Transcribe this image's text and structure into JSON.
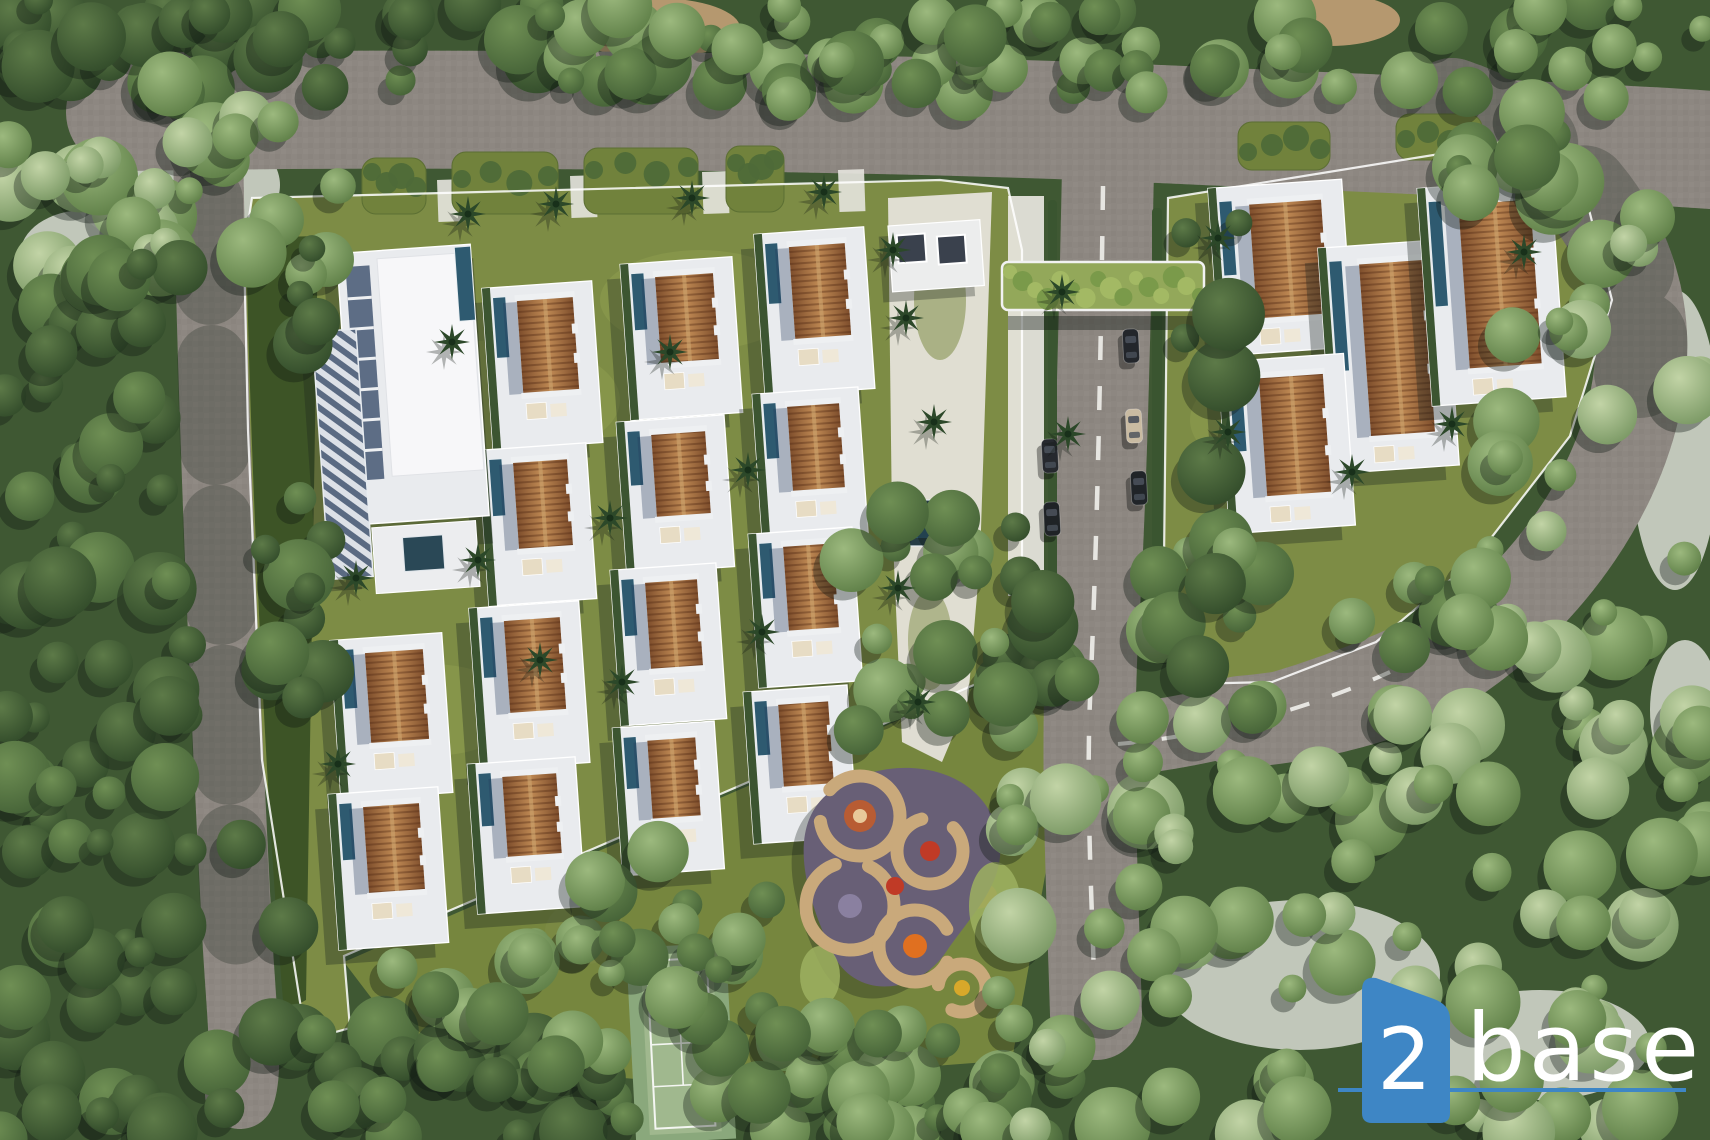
{
  "watermark": {
    "number": "2",
    "name": "base",
    "badge_color": "#3e86c5",
    "underline_color": "#3e86c5",
    "text_color": "#ffffff"
  },
  "scene": {
    "description": "Aerial 3D master-plan render of a tropical villa resort: two clusters of brown-roofed pool villas amid forest, central access road with cars, entrance pergola, clubhouse, kids playground, tennis court and perimeter roads",
    "counts": {
      "villas": 18,
      "clubhouse": 1,
      "cars": 5,
      "playground": 1,
      "tennis_court": 1
    },
    "features": [
      "forest",
      "perimeter-road",
      "central-road",
      "entrance-pergola",
      "villa-clusters",
      "private-pools",
      "clubhouse",
      "spine-garden",
      "water-feature",
      "kids-playground",
      "tennis-court",
      "parking-bays"
    ],
    "palette": {
      "forest_dark": "#2f4a28",
      "forest_mid": "#48663a",
      "forest_light": "#6f915c",
      "forest_pale": "#93af7c",
      "lawn": "#7d8c45",
      "hedge": "#3a5530",
      "road": "#8d8781",
      "plot_white": "#e9ebee",
      "roof_brown": "#a06438",
      "pool_blue": "#2e5a70",
      "shadow_blue": "rgba(35,55,90,0.32)",
      "playground_sand": "#c9a97b",
      "playground_base": "#685f76",
      "tennis_green": "#a0b88e"
    }
  },
  "scene_data": {
    "bg": "#3f5833",
    "pale_blobs": [
      [
        70,
        120,
        210,
        130
      ],
      [
        20,
        210,
        130,
        90
      ],
      [
        1160,
        900,
        280,
        150
      ],
      [
        1430,
        990,
        220,
        110
      ],
      [
        1630,
        290,
        90,
        300
      ],
      [
        545,
        900,
        80,
        64
      ],
      [
        1650,
        640,
        70,
        140
      ]
    ],
    "tan_blobs": [
      [
        655,
        28,
        85,
        30
      ],
      [
        1330,
        20,
        70,
        26
      ]
    ],
    "lawns": {
      "left": "M252,198 L940,180 L1008,188 L1022,250 L1022,648 L1004,672 L344,956 L350,1028 L306,1040 L262,760 L248,430 L244,250 Z",
      "below": "M344,962 L1000,676 L1062,700 L1064,770 L1012,1060 L700,1084 L420,1062 Z",
      "right": "M1168,198 L1452,152 L1585,194 L1612,300 L1570,436 L1474,560 L1376,642 L1272,682 L1186,684 L1164,560 Z",
      "right_ne": "M1490,120 L1648,152 L1658,250 L1600,298 L1556,200 Z",
      "patches": [
        [
          500,
          400,
          120,
          60
        ],
        [
          700,
          300,
          100,
          50
        ],
        [
          430,
          710,
          90,
          46
        ],
        [
          1300,
          420,
          110,
          60
        ],
        [
          880,
          880,
          70,
          40
        ]
      ]
    },
    "roads": {
      "color": "#8d8781",
      "paths": [
        [
          "M125,112 C480,106 900,112 1205,126 C1430,136 1600,142 1712,150",
          118
        ],
        [
          "M208,140 C212,420 228,760 238,950 C243,1030 248,1072 240,1094",
          70
        ],
        [
          "M1108,168 C1104,360 1100,520 1092,640 C1086,760 1092,880 1096,1014",
          92
        ],
        [
          "M1098,742 C1180,736 1290,712 1398,664",
          72
        ],
        [
          "M1452,104 C1582,148 1652,258 1640,372 C1628,486 1546,598 1448,662 C1396,696 1312,716 1240,722",
          92
        ]
      ],
      "shade": [
        [
          "M208,200 C214,480 228,780 238,960",
          70
        ],
        [
          "M1452,104 C1582,148 1652,258 1640,372",
          92
        ]
      ],
      "dashes": [
        [
          "M1103,186 C1100,420 1096,560 1090,700 C1086,800 1092,900 1095,1008",
          4.5,
          "24 26"
        ],
        [
          "M1118,744 C1200,737 1300,713 1390,672",
          4,
          "20 24"
        ]
      ]
    },
    "hedge_wedge": "M246,238 L318,236 L306,1000 L284,1012 C264,780 250,440 246,238 Z",
    "sidewalk": [
      1008,
      196,
      36,
      400
    ],
    "hedge_strips": [
      [
        1048,
        200,
        9,
        380
      ],
      [
        1152,
        208,
        10,
        340
      ]
    ],
    "parking_hedges": [
      [
        362,
        158,
        64,
        56
      ],
      [
        452,
        152,
        106,
        62
      ],
      [
        584,
        148,
        114,
        66
      ],
      [
        726,
        146,
        58,
        66
      ],
      [
        1238,
        122,
        92,
        48
      ],
      [
        1396,
        114,
        86,
        46
      ]
    ],
    "stubs": [
      [
        437,
        180,
        26,
        42
      ],
      [
        570,
        176,
        26,
        42
      ],
      [
        702,
        172,
        26,
        42
      ],
      [
        838,
        170,
        26,
        42
      ]
    ],
    "spine": {
      "path": "M888,198 L992,192 L980,560 L968,700 L942,762 L902,742 L892,520 Z",
      "water": [
        898,
        500,
        42,
        46
      ]
    },
    "amenity": {
      "x": 888,
      "y": 226,
      "w": 92,
      "h": 66,
      "cabins": [
        [
          8,
          10,
          28,
          28
        ],
        [
          48,
          14,
          28,
          28
        ]
      ]
    },
    "pergola": {
      "x": 1002,
      "y": 262,
      "w": 202,
      "h": 48
    },
    "villas": {
      "angle": -4,
      "left": [
        [
          368,
          648,
          58,
          96
        ],
        [
          366,
          802,
          56,
          92
        ],
        [
          520,
          296,
          56,
          98
        ],
        [
          516,
          458,
          54,
          92
        ],
        [
          507,
          616,
          56,
          98
        ],
        [
          505,
          772,
          54,
          86
        ],
        [
          658,
          272,
          58,
          92
        ],
        [
          654,
          430,
          54,
          88
        ],
        [
          648,
          578,
          52,
          92
        ],
        [
          650,
          736,
          48,
          84
        ],
        [
          792,
          242,
          56,
          98
        ],
        [
          790,
          402,
          52,
          90
        ],
        [
          786,
          542,
          50,
          90
        ],
        [
          781,
          700,
          50,
          88
        ]
      ],
      "right": [
        [
          1253,
          199,
          72,
          120
        ],
        [
          1365,
          259,
          64,
          178
        ],
        [
          1464,
          199,
          72,
          170
        ],
        [
          1263,
          373,
          64,
          124
        ]
      ]
    },
    "clubhouse": {
      "x": 360,
      "y": 274
    },
    "trellis": {
      "x": 312,
      "y": 332,
      "w": 44,
      "h": 248
    },
    "cars": [
      [
        1050,
        456,
        -3,
        "#26292e"
      ],
      [
        1052,
        519,
        -3,
        "#1f2326"
      ],
      [
        1131,
        346,
        -3,
        "#23262b"
      ],
      [
        1134,
        426,
        -3,
        "#c9bba2"
      ],
      [
        1139,
        488,
        -3,
        "#202428"
      ]
    ],
    "playground": {
      "x": 790,
      "y": 756,
      "base": "M40,36 C96,-4 180,6 204,64 C226,118 186,152 156,196 C126,240 64,244 42,196 C20,150 -8,72 40,36 Z",
      "rings": [
        [
          70,
          60,
          40
        ],
        [
          140,
          95,
          33
        ],
        [
          60,
          150,
          44
        ],
        [
          125,
          190,
          36
        ],
        [
          172,
          232,
          24
        ]
      ],
      "dots": [
        [
          70,
          60,
          16,
          "#b85c33"
        ],
        [
          70,
          60,
          7,
          "#e8c99a"
        ],
        [
          140,
          95,
          10,
          "#c03a26"
        ],
        [
          125,
          190,
          12,
          "#e07020"
        ],
        [
          60,
          150,
          12,
          "#8a80a0"
        ],
        [
          172,
          232,
          8,
          "#d8a82a"
        ],
        [
          105,
          130,
          9,
          "#c03a26"
        ]
      ],
      "greens": [
        [
          205,
          150,
          26,
          44
        ],
        [
          30,
          220,
          20,
          30
        ]
      ]
    },
    "tennis": {
      "x": 626,
      "y": 948,
      "angle": -3
    },
    "forest": [
      [
        0,
        0,
        560,
        95,
        36,
        0
      ],
      [
        540,
        0,
        260,
        85,
        18,
        1
      ],
      [
        780,
        0,
        930,
        100,
        54,
        1
      ],
      [
        0,
        70,
        340,
        210,
        30,
        2
      ],
      [
        0,
        260,
        190,
        420,
        30,
        0
      ],
      [
        0,
        660,
        200,
        390,
        30,
        0
      ],
      [
        0,
        1030,
        640,
        110,
        34,
        0
      ],
      [
        600,
        1040,
        480,
        100,
        22,
        1
      ],
      [
        330,
        930,
        280,
        140,
        14,
        1
      ],
      [
        560,
        840,
        220,
        140,
        10,
        1
      ],
      [
        700,
        990,
        330,
        150,
        18,
        1
      ],
      [
        1010,
        700,
        700,
        440,
        88,
        2
      ],
      [
        1500,
        150,
        210,
        570,
        28,
        2
      ],
      [
        990,
        520,
        90,
        230,
        12,
        0
      ],
      [
        1140,
        530,
        130,
        190,
        12,
        1
      ],
      [
        840,
        490,
        160,
        250,
        16,
        1
      ],
      [
        1180,
        200,
        70,
        470,
        8,
        0
      ],
      [
        1320,
        430,
        180,
        220,
        12,
        1
      ],
      [
        1420,
        110,
        140,
        110,
        8,
        1
      ],
      [
        240,
        230,
        90,
        700,
        16,
        0
      ],
      [
        610,
        920,
        130,
        80,
        7,
        1
      ]
    ],
    "palms": [
      [
        468,
        214
      ],
      [
        556,
        204
      ],
      [
        692,
        198
      ],
      [
        824,
        192
      ],
      [
        906,
        318
      ],
      [
        934,
        422
      ],
      [
        898,
        588
      ],
      [
        918,
        702
      ],
      [
        452,
        342
      ],
      [
        478,
        560
      ],
      [
        610,
        518
      ],
      [
        622,
        682
      ],
      [
        748,
        470
      ],
      [
        762,
        632
      ],
      [
        356,
        578
      ],
      [
        338,
        764
      ],
      [
        1218,
        238
      ],
      [
        1228,
        432
      ],
      [
        1352,
        472
      ],
      [
        1452,
        424
      ],
      [
        1524,
        252
      ],
      [
        1062,
        292
      ],
      [
        1068,
        434
      ],
      [
        893,
        250
      ],
      [
        670,
        352
      ],
      [
        540,
        660
      ]
    ]
  }
}
